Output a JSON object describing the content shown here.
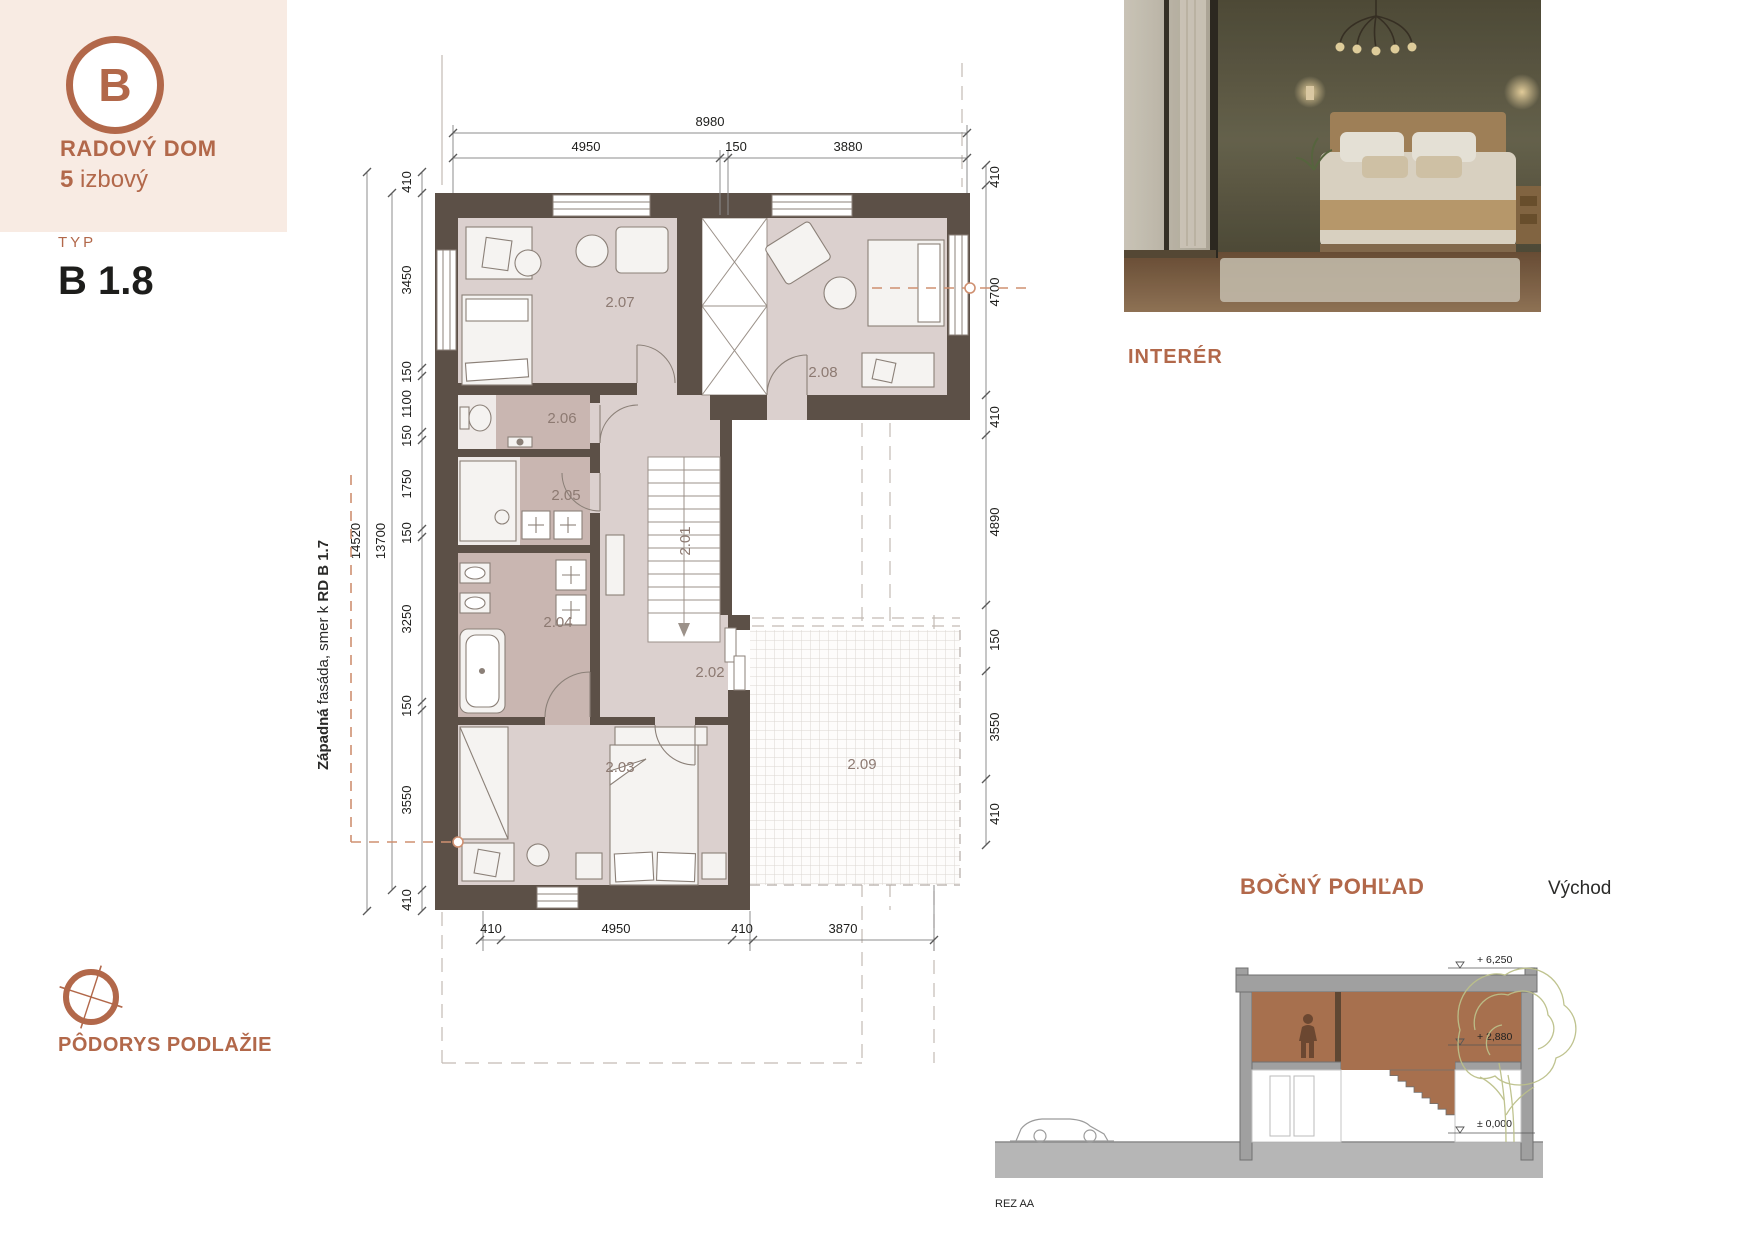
{
  "badge": {
    "letter": "B",
    "title": "RADOVÝ DOM",
    "rooms_count": "5",
    "rooms_label": " izbový"
  },
  "type": {
    "label": "TYP",
    "value": "B 1.8"
  },
  "plan_caption": "PÔDORYS PODLAŽIE",
  "interior": {
    "label": "INTERÉR"
  },
  "side_view": {
    "title": "BOČNÝ POHĽAD",
    "direction": "Východ",
    "section_ref": "REZ AA",
    "levels": {
      "roof": "+ 6,250",
      "upper_floor": "+ 2,880",
      "ground": "± 0,000"
    }
  },
  "plan": {
    "rooms": [
      "2.01",
      "2.02",
      "2.03",
      "2.04",
      "2.05",
      "2.06",
      "2.07",
      "2.08",
      "2.09"
    ],
    "dims": {
      "top_total": "8980",
      "top": [
        "4950",
        "150",
        "3880"
      ],
      "left_outer": "14520",
      "left_inner": "13700",
      "left": [
        "410",
        "3450",
        "150",
        "1100",
        "150",
        "1750",
        "150",
        "3250",
        "150",
        "3550",
        "410"
      ],
      "right": [
        "410",
        "4700",
        "410",
        "4890",
        "150",
        "3550",
        "410"
      ],
      "bottom": [
        "410",
        "4950",
        "410",
        "3870"
      ]
    },
    "west_facade": {
      "prefix": "Západná",
      "middle": " fasáda, smer k ",
      "target": "RD B 1.7"
    },
    "east_facade": {
      "prefix": "Východná",
      "middle": " fasáda, smer k ",
      "target": "RD B 1.9"
    }
  },
  "colors": {
    "accent": "#b2684a",
    "panel": "#f8ebe3",
    "wall": "#5c5047",
    "room": "#dbd0ce",
    "room_dark": "#c9b6b1",
    "dash_orange": "#cf9071",
    "section_fill": "#a7704e",
    "tree": "#bcc08a"
  }
}
